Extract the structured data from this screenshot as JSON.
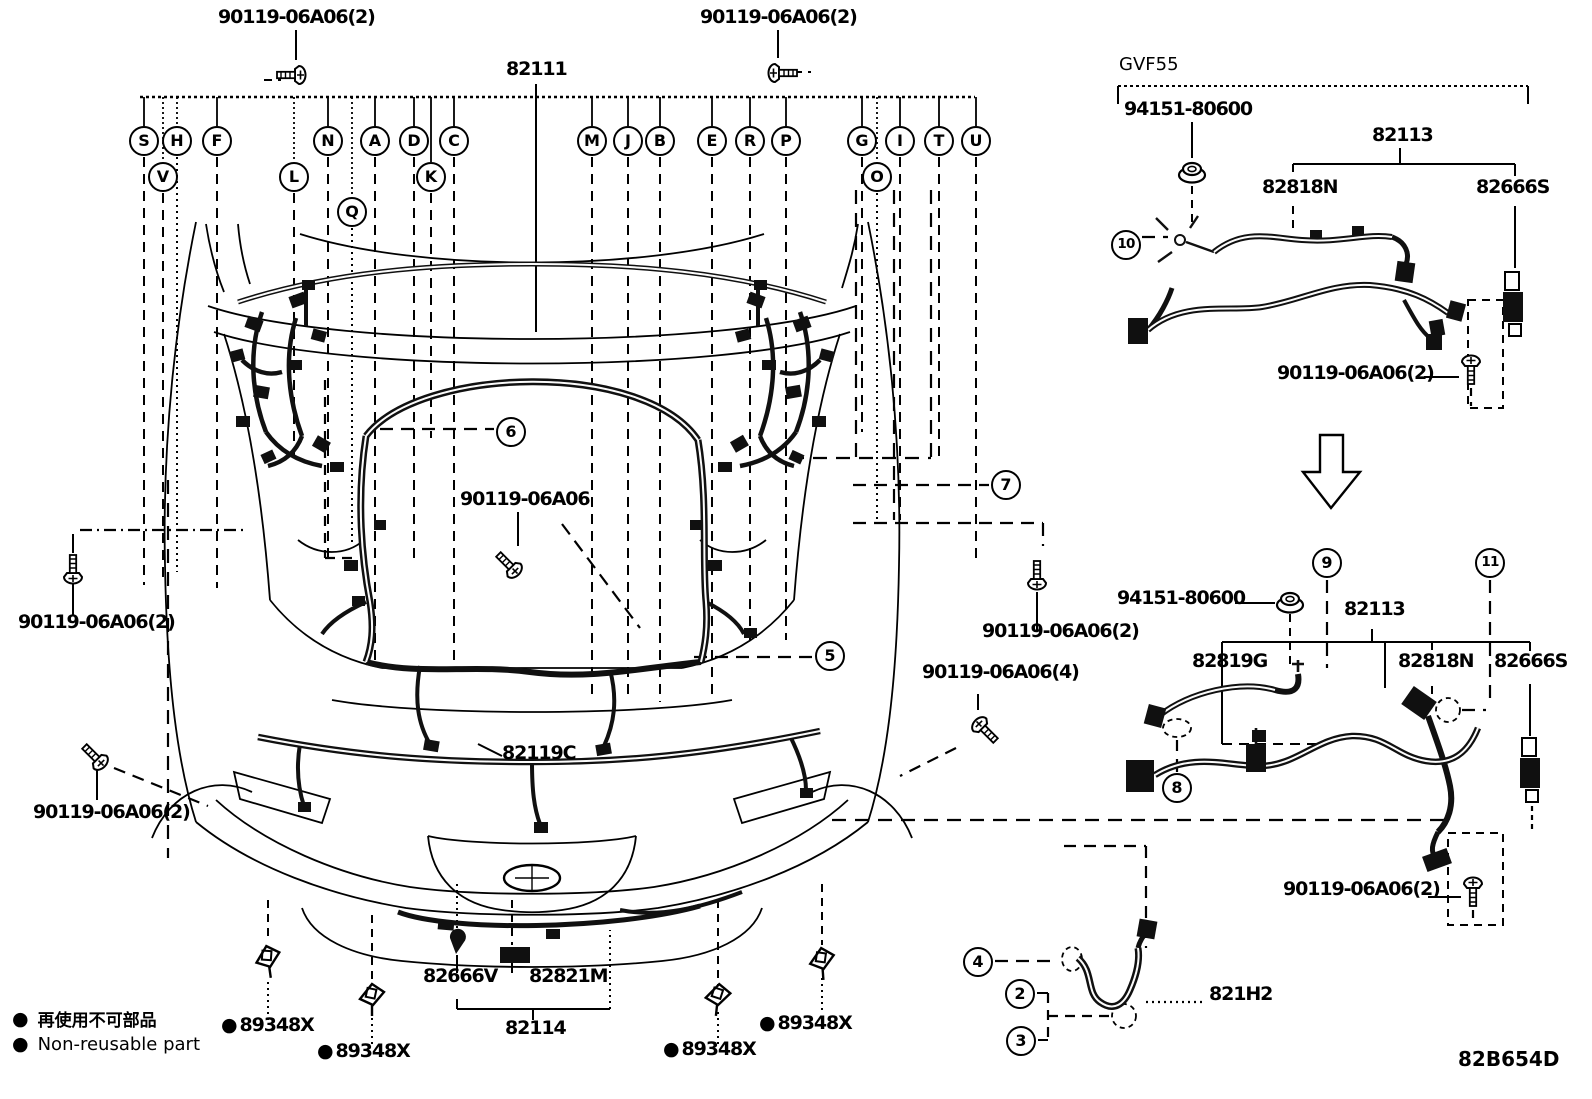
{
  "diagram": {
    "code": "82B654D",
    "variant": "GVF55"
  },
  "legend": {
    "bullet": "●",
    "jp": "再使用不可部品",
    "en": "Non-reusable part"
  },
  "parts": {
    "main_harness": "82111",
    "engine_room_no2": "82113",
    "bolt_2": "90119-06A06(2)",
    "bolt_4": "90119-06A06(4)",
    "bolt": "90119-06A06",
    "nut": "94151-80600",
    "wire_82818N": "82818N",
    "wire_82819G": "82819G",
    "connector_82666S": "82666S",
    "connector_82666V": "82666V",
    "wire_82119C": "82119C",
    "cover_82821M": "82821M",
    "harness_82114": "82114",
    "clamp_89348X": "89348X",
    "wire_821H2": "821H2"
  },
  "connector_circles": [
    "S",
    "H",
    "F",
    "V",
    "L",
    "N",
    "A",
    "D",
    "C",
    "K",
    "Q",
    "M",
    "J",
    "B",
    "E",
    "R",
    "P",
    "G",
    "I",
    "T",
    "U",
    "O"
  ],
  "callouts": {
    "c2": "2",
    "c3": "3",
    "c4": "4",
    "c5": "5",
    "c6": "6",
    "c7": "7",
    "c8": "8",
    "c9": "9",
    "c10": "10",
    "c11": "11"
  }
}
